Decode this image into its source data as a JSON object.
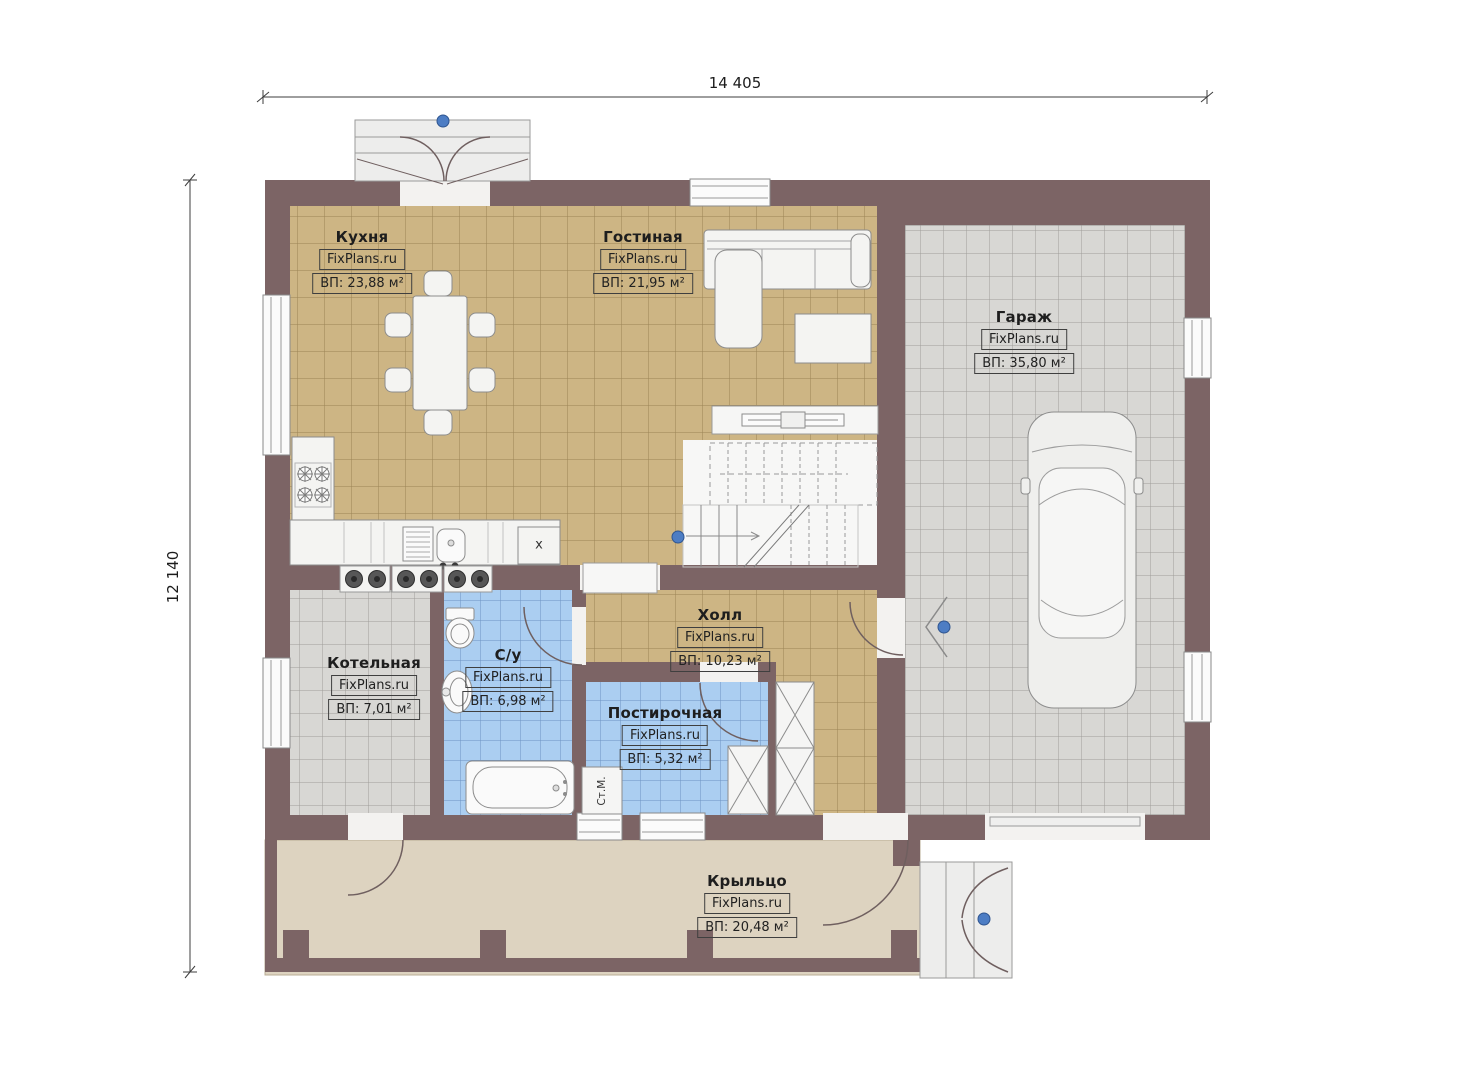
{
  "dimensions": {
    "width_label": "14 405",
    "height_label": "12 140"
  },
  "rooms": {
    "kitchen": {
      "name": "Кухня",
      "brand": "FixPlans.ru",
      "area": "ВП: 23,88 м²"
    },
    "living": {
      "name": "Гостиная",
      "brand": "FixPlans.ru",
      "area": "ВП: 21,95 м²"
    },
    "garage": {
      "name": "Гараж",
      "brand": "FixPlans.ru",
      "area": "ВП: 35,80 м²"
    },
    "boiler": {
      "name": "Котельная",
      "brand": "FixPlans.ru",
      "area": "ВП: 7,01 м²"
    },
    "bathroom": {
      "name": "С/у",
      "brand": "FixPlans.ru",
      "area": "ВП: 6,98 м²"
    },
    "laundry": {
      "name": "Постирочная",
      "brand": "FixPlans.ru",
      "area": "ВП: 5,32 м²"
    },
    "hall": {
      "name": "Холл",
      "brand": "FixPlans.ru",
      "area": "ВП: 10,23 м²"
    },
    "porch": {
      "name": "Крыльцо",
      "brand": "FixPlans.ru",
      "area": "ВП: 20,48 м²"
    }
  },
  "annotations": {
    "washing_machine": "Ст.М.",
    "cabinet_mark": "х"
  },
  "colors": {
    "wall": "#7c6465",
    "tan_floor": "#cdb584",
    "gray_floor": "#d8d7d4",
    "blue_floor": "#abcef1",
    "porch_floor": "#ddd3c0",
    "marker_blue": "#4d7dc4"
  }
}
